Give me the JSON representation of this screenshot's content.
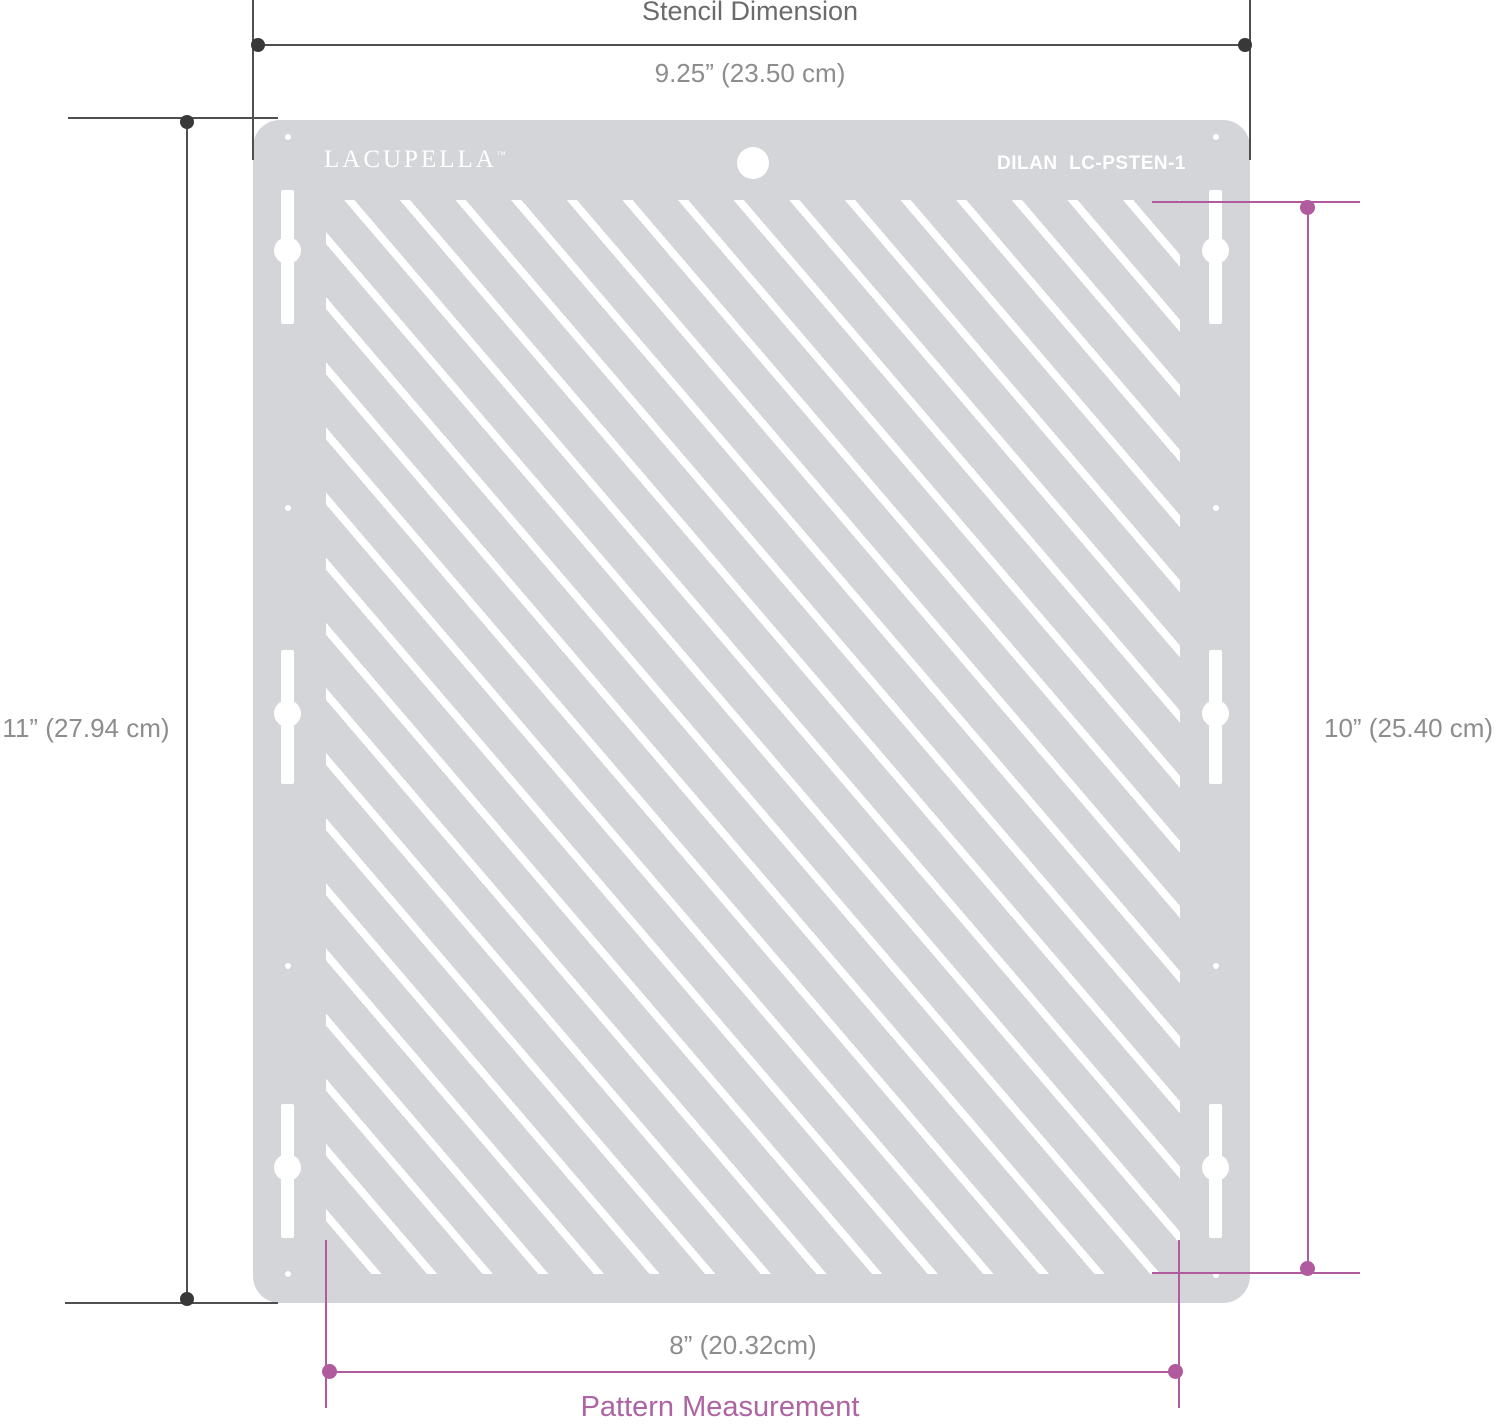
{
  "colors": {
    "plate": "#d3d5d8",
    "white": "#ffffff",
    "dim_dark": "#4f4f4f",
    "dot_dark": "#383838",
    "label_gray": "#8d8d8d",
    "title_gray": "#6b6b6b",
    "pink": "#b15b9f",
    "pink_text": "#ae64a2"
  },
  "stencil": {
    "brand": "LACUPELLA",
    "brand_tm": "™",
    "part_number": "DILAN  LC-PSTEN-1"
  },
  "measurements": {
    "stencil_width": {
      "title": "Stencil Dimension",
      "value": "9.25” (23.50 cm)"
    },
    "stencil_height": {
      "value": "11” (27.94 cm)"
    },
    "pattern_height": {
      "value": "10” (25.40 cm)"
    },
    "pattern_width": {
      "value": "8” (20.32cm)",
      "title": "Pattern Measurement"
    }
  }
}
